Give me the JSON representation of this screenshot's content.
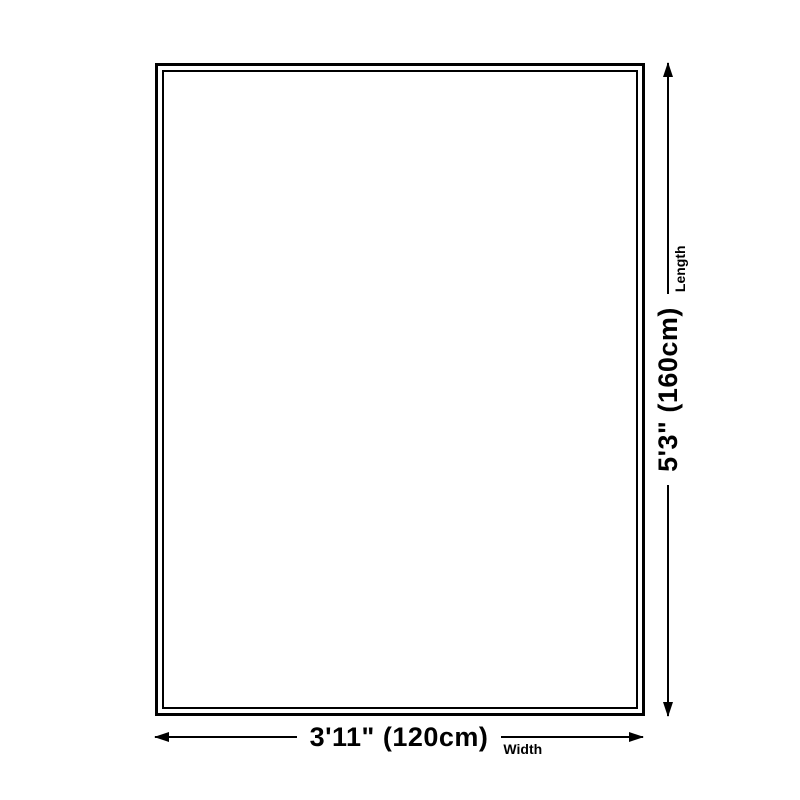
{
  "diagram": {
    "type": "product-size-diagram",
    "background_color": "#ffffff",
    "line_color": "#000000",
    "width_dim": {
      "value": "3'11\" (120cm)",
      "label": "Width"
    },
    "length_dim": {
      "value": "5'3\" (160cm)",
      "label": "Length"
    }
  }
}
